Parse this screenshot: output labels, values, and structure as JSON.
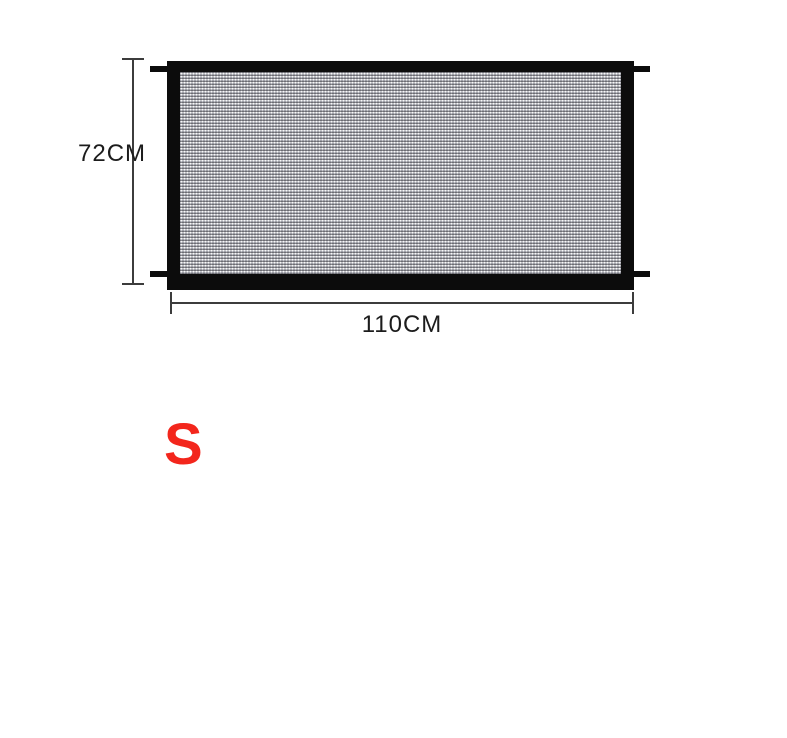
{
  "product": {
    "name": "mesh-safety-gate",
    "frame_color": "#0c0c0c",
    "mesh_color": "#90919a"
  },
  "dimensions": {
    "height_label": "72CM",
    "width_label": "110CM",
    "line_color": "#3c3c3c",
    "text_color": "#1c1c1c"
  },
  "size_badge": {
    "label": "S",
    "color": "#f3261c"
  },
  "page": {
    "background": "#ffffff"
  }
}
